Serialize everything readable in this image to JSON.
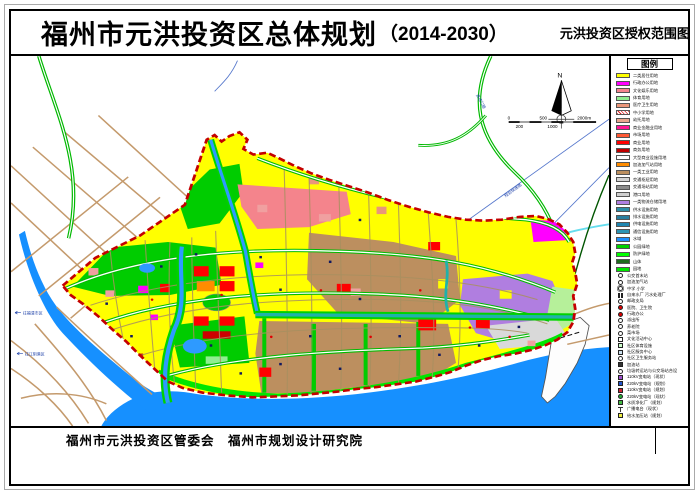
{
  "page": {
    "title": "福州市元洪投资区总体规划",
    "title_paren": "（2014-2030）",
    "subtitle": "元洪投资区授权范围图",
    "footer": "福州市元洪投资区管委会　福州市规划设计研究院"
  },
  "compass": {
    "north_label": "N"
  },
  "scale_bar": {
    "label_0": "0",
    "label_500": "500",
    "label_2000": "2000m",
    "label_200": "200",
    "label_1000": "1000"
  },
  "map_labels": {
    "expressway": "高速公路",
    "planned_road": "规划快速路",
    "dir_west": "往福清市区",
    "dir_south": "往江阴港区"
  },
  "legend": {
    "title": "图例",
    "landuse": [
      {
        "label": "二类居住用地",
        "color": "#FFFF00"
      },
      {
        "label": "行政办公用地",
        "color": "#FF00FF"
      },
      {
        "label": "文化娱乐用地",
        "color": "#F4848C"
      },
      {
        "label": "体育用地",
        "color": "#90EE90"
      },
      {
        "label": "医疗卫生用地",
        "color": "#E9967A"
      },
      {
        "label": "中小学用地",
        "color": "#FFFFFF",
        "hatch": true
      },
      {
        "label": "幼托用地",
        "color": "#E8A58C"
      },
      {
        "label": "商业金融业用地",
        "color": "#FF1493"
      },
      {
        "label": "市场用地",
        "color": "#FF5A36"
      },
      {
        "label": "商业用地",
        "color": "#FF0000"
      },
      {
        "label": "商务用地",
        "color": "#C00000"
      },
      {
        "label": "大型商业设施用地",
        "color": "#FFFFFF"
      },
      {
        "label": "加油加气站用地",
        "color": "#FF8C00"
      },
      {
        "label": "一类工业用地",
        "color": "#BC8F5F"
      },
      {
        "label": "交通枢纽用地",
        "color": "#D3D3D3"
      },
      {
        "label": "交通场站用地",
        "color": "#8C8C8C"
      },
      {
        "label": "港口用地",
        "color": "#CFCFCF"
      },
      {
        "label": "一类物流仓储用地",
        "color": "#B07EE0"
      },
      {
        "label": "供水设施用地",
        "color": "#2D8FA8"
      },
      {
        "label": "排水设施用地",
        "color": "#297FA0"
      },
      {
        "label": "供电设施用地",
        "color": "#1F86B0"
      },
      {
        "label": "通信设施用地",
        "color": "#2D94B4"
      },
      {
        "label": "水域",
        "color": "#1E90FF"
      },
      {
        "label": "公园绿地",
        "color": "#00D200"
      },
      {
        "label": "防护绿地",
        "color": "#00FF00"
      },
      {
        "label": "山体",
        "color": "#1E6B1E"
      },
      {
        "label": "园地",
        "color": "#00E600"
      }
    ],
    "symbols": [
      {
        "label": "公交首末站",
        "shape": "circle",
        "fill": "#ffffff"
      },
      {
        "label": "加油加气站",
        "shape": "circle",
        "fill": "#ffffff"
      },
      {
        "label": "中学 小学",
        "shape": "circle2",
        "fill": "#ffffff"
      },
      {
        "label": "自来水厂 污水处理厂",
        "shape": "pair",
        "fill": "#222222"
      },
      {
        "label": "邮政支局",
        "shape": "circle",
        "fill": "#ffffff"
      },
      {
        "label": "医院、卫生院",
        "shape": "circle",
        "fill": "#dd0000"
      },
      {
        "label": "行政办公",
        "shape": "circle",
        "fill": "#dd0000"
      },
      {
        "label": "派出所",
        "shape": "circle",
        "fill": "#ffffff"
      },
      {
        "label": "养老院",
        "shape": "circle",
        "fill": "#ffffff"
      },
      {
        "label": "菜市场",
        "shape": "circle",
        "fill": "#ffffff"
      },
      {
        "label": "文化活动中心",
        "shape": "square",
        "fill": "#ffffff"
      },
      {
        "label": "社区体育设施",
        "shape": "square",
        "fill": "#ccffcc"
      },
      {
        "label": "社区服务中心",
        "shape": "square",
        "fill": "#cce0ee"
      },
      {
        "label": "社区卫生服务站",
        "shape": "circle",
        "fill": "#ffffff"
      },
      {
        "label": "加油站",
        "shape": "square",
        "fill": "#333333"
      },
      {
        "label": "垃圾转运站与公交场站合设",
        "shape": "circle",
        "fill": "#ffffff"
      },
      {
        "label": "110kV变电站（现状）",
        "shape": "square",
        "fill": "#A050D0"
      },
      {
        "label": "220kV变电站（规划）",
        "shape": "square",
        "fill": "#2255CC"
      },
      {
        "label": "110kV变电站（规划）",
        "shape": "square",
        "fill": "#CC2233"
      },
      {
        "label": "220kV变电站（现状）",
        "shape": "circle",
        "fill": "#22AA33"
      },
      {
        "label": "水质净化厂（规划）",
        "shape": "square",
        "fill": "#44BB44"
      },
      {
        "label": "广播电台（现状）",
        "shape": "tee",
        "fill": "#333333"
      },
      {
        "label": "给水加压站（规划）",
        "shape": "square",
        "fill": "#EEEE44"
      }
    ]
  }
}
